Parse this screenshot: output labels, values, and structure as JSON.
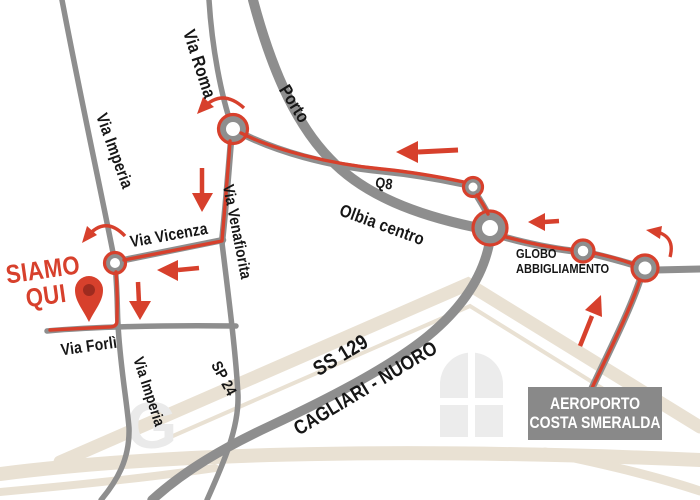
{
  "labels": {
    "via_imperia_top": "Via Imperia",
    "via_roma": "Via Roma",
    "porto": "Porto",
    "q8": "Q8",
    "olbia_centro": "Olbia centro",
    "via_venafiorita": "Via Venafiorita",
    "via_vicenza": "Via Vicenza",
    "via_forli": "Via Forlì",
    "via_imperia_bottom": "Via Imperia",
    "sp_24": "SP 24",
    "ss_129": "SS 129",
    "cagliari_nuoro": "CAGLIARI - NUORO"
  },
  "marker": {
    "line1": "SIAMO",
    "line2": "QUI"
  },
  "pois": {
    "globo": {
      "line1": "GLOBO",
      "line2": "ABBIGLIAMENTO"
    },
    "aeroporto": {
      "line1": "AEROPORTO",
      "line2": "COSTA SMERALDA"
    }
  },
  "colors": {
    "route_red": "#d7402c",
    "pin_inner_red": "#9e2b1f",
    "road_gray": "#8e8e8e",
    "sign_gray": "#898989",
    "watermark_beige": "#e9e1d3",
    "watermark_window_gray": "#ececec"
  }
}
